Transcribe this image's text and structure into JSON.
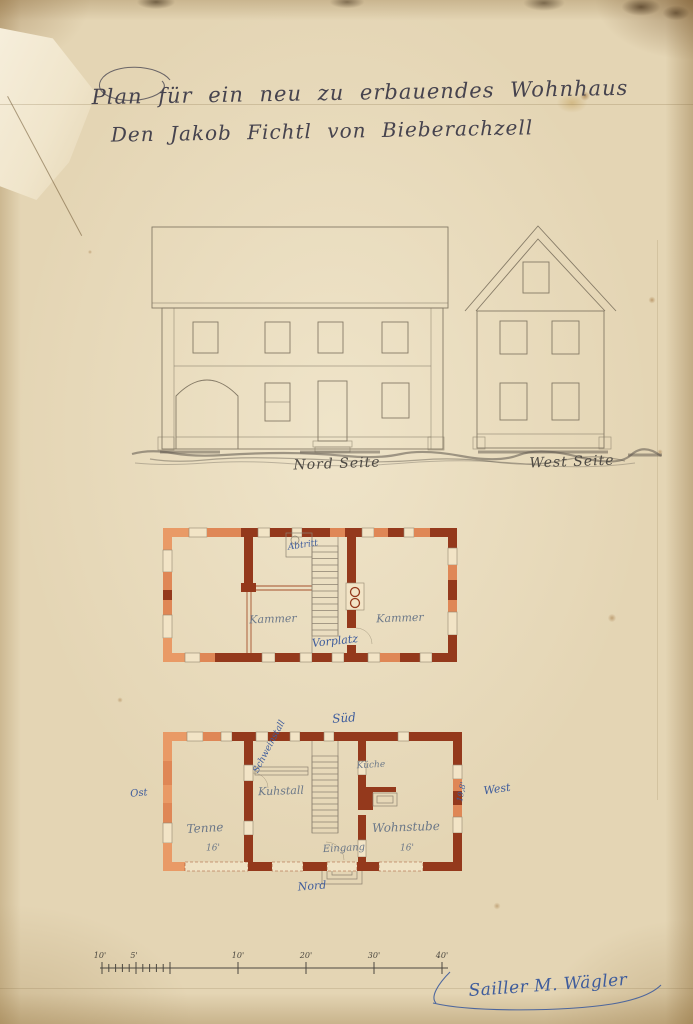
{
  "title": {
    "line1": "Plan für ein neu zu erbauendes Wohnhaus",
    "line2": "Den Jakob Fichtl von Bieberachzell"
  },
  "elevations": {
    "north_caption": "Nord Seite",
    "west_caption": "West Seite"
  },
  "upper_plan": {
    "abtritt": "Abtritt",
    "kammer_left": "Kammer",
    "kammer_right": "Kammer",
    "vorplatz": "Vorplatz"
  },
  "ground_plan": {
    "tenne": "Tenne",
    "tenne_dim": "16'",
    "kuhstall": "Kuhstall",
    "schweinstall": "Schweinstall",
    "kueche": "Küche",
    "wohnstube": "Wohnstube",
    "wohnstube_dim": "16'",
    "eingang": "Eingang",
    "right_wall_dim": "19,8'"
  },
  "orientation": {
    "sued": "Süd",
    "nord": "Nord",
    "ost": "Ost",
    "west": "West"
  },
  "scale_bar": {
    "marks": [
      "10'",
      "5'",
      "10'",
      "20'",
      "30'",
      "40'"
    ]
  },
  "signature": {
    "text": "Sailler M. Wägler"
  },
  "colors": {
    "paper": "#e4d5b4",
    "wall_dark": "#94391c",
    "wall_salmon": "#df8756",
    "ink_blue": "#3e5c9c",
    "pencil_blue": "#5b6b82",
    "drawing_line": "#857a66"
  }
}
